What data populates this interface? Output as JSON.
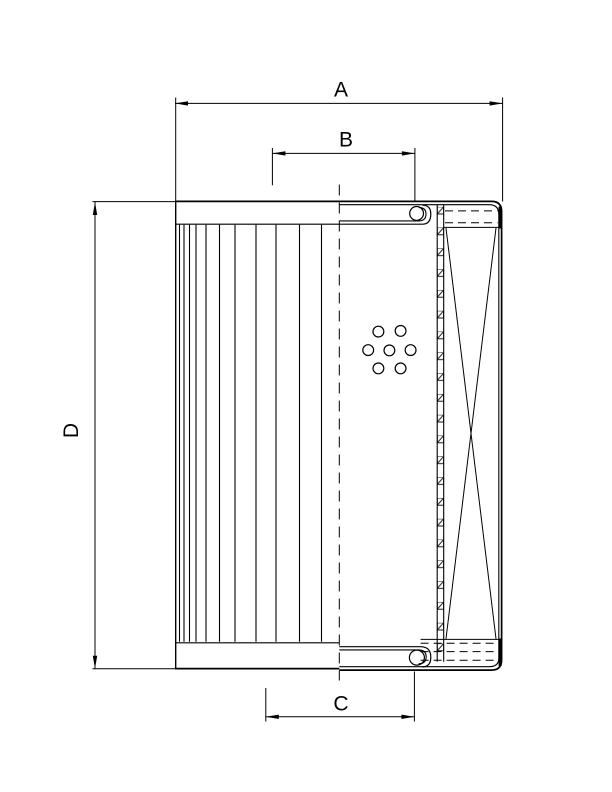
{
  "figure": {
    "type": "technical-diagram",
    "subject": "filter-element-cross-section-drawing",
    "background_color": "#ffffff",
    "line_color": "#000000"
  },
  "dimensions": {
    "overall_width_label": "A",
    "top_inner_width_label": "B",
    "bottom_inner_width_label": "C",
    "overall_height_label": "D"
  }
}
